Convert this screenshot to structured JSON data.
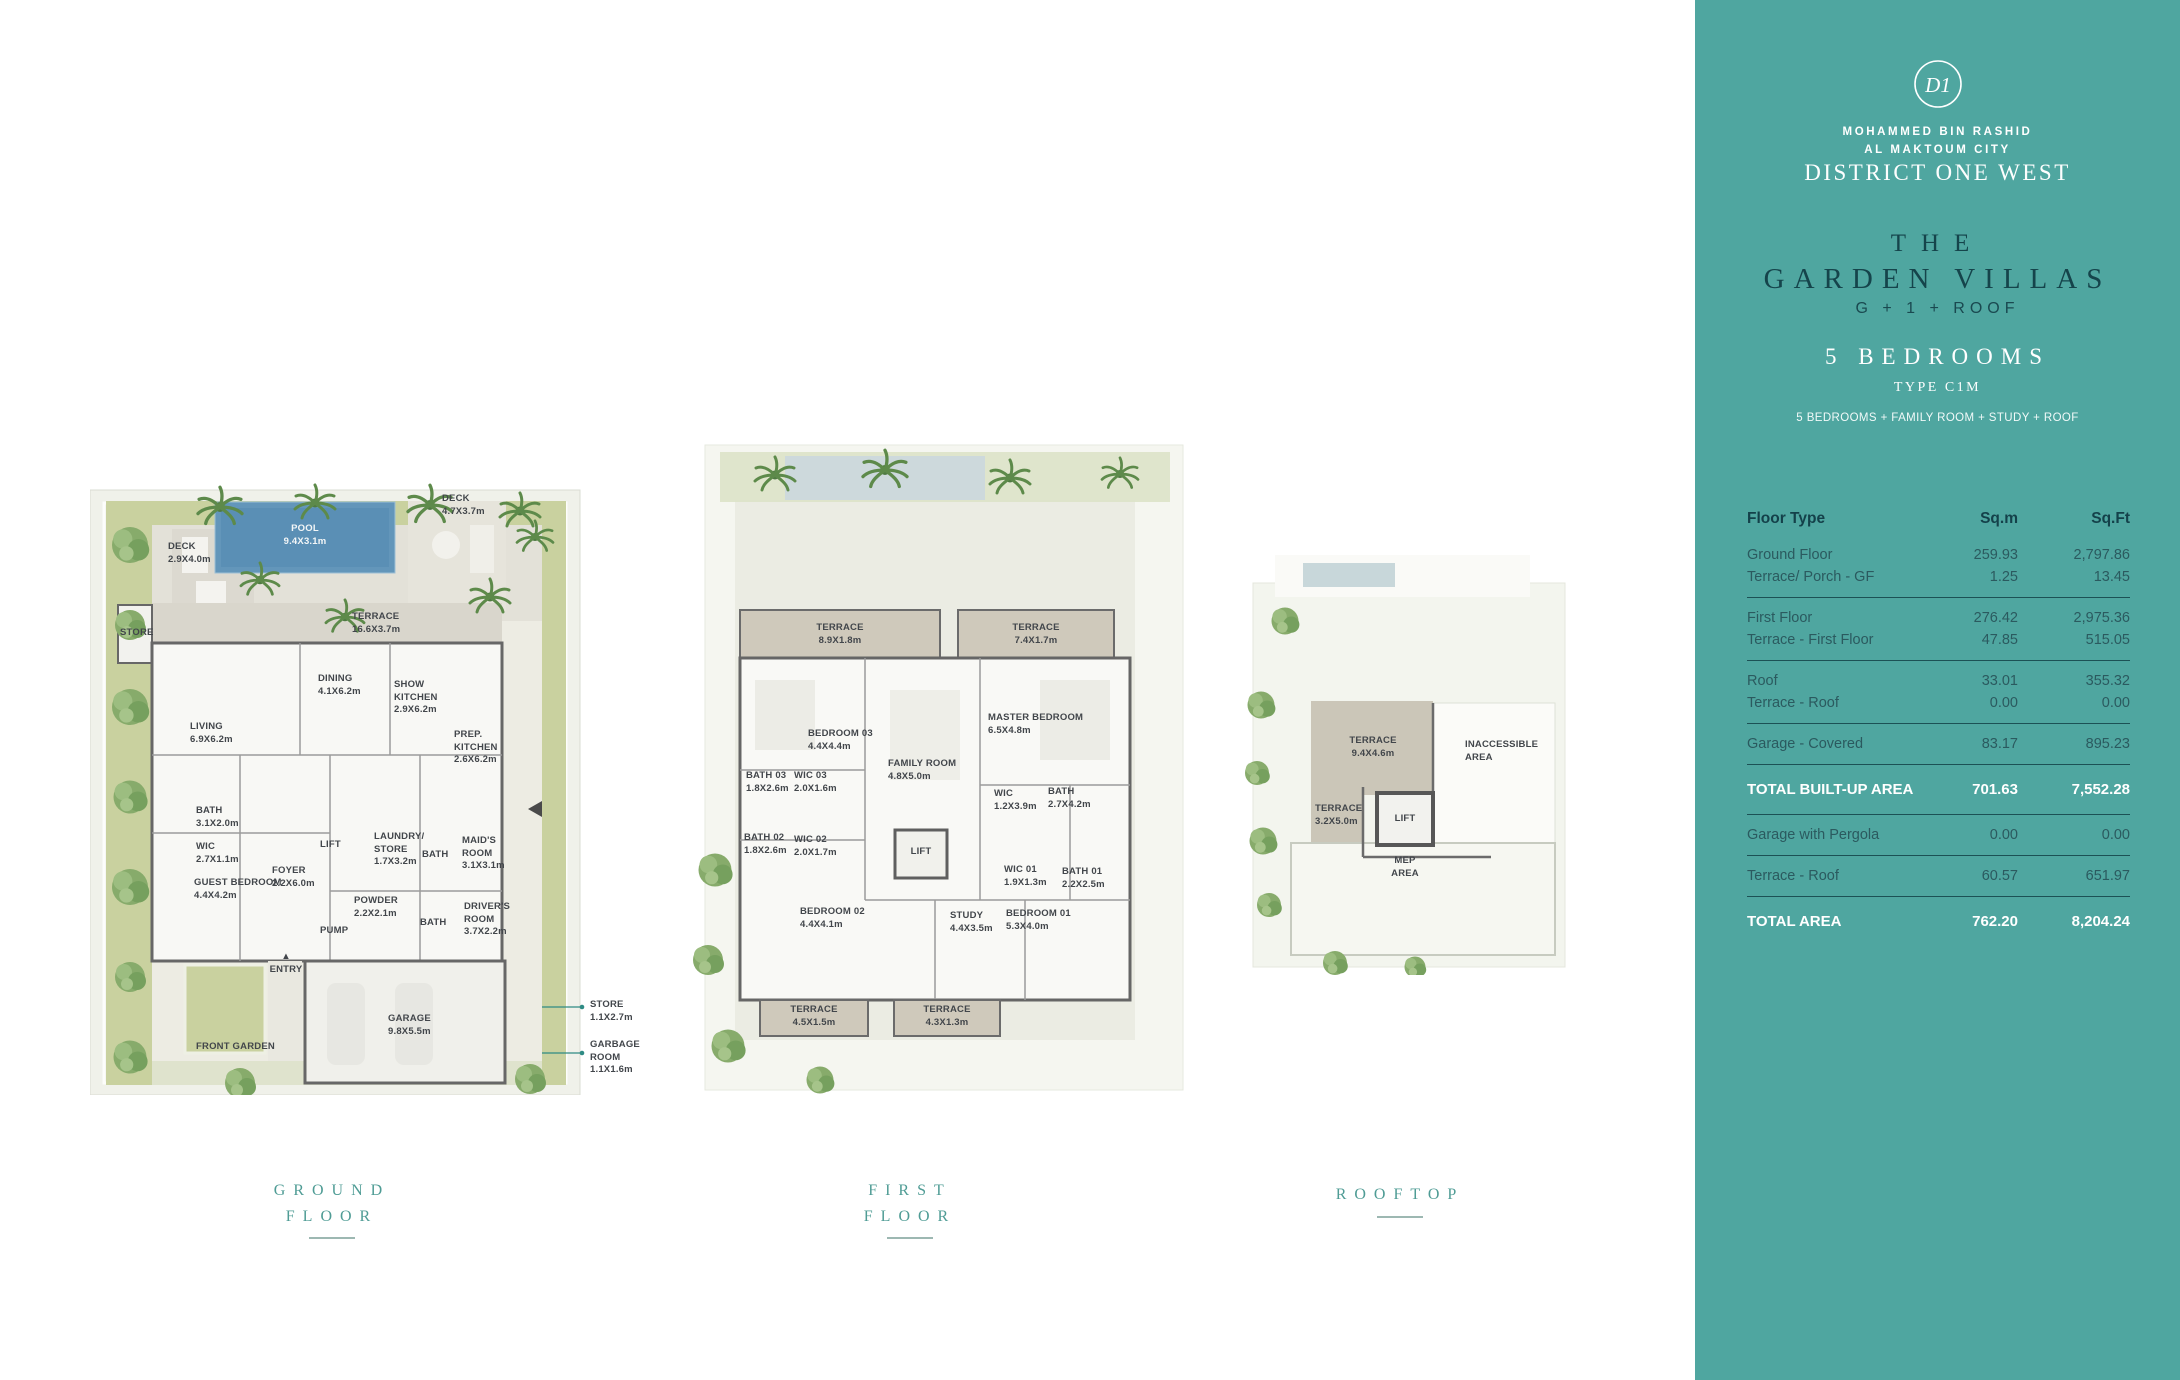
{
  "brand": {
    "logo_monogram": "D1",
    "org_line1": "MOHAMMED BIN RASHID",
    "org_line2": "AL MAKTOUM CITY",
    "development": "DISTRICT ONE WEST"
  },
  "villa": {
    "title_line1": "THE",
    "title_line2": "GARDEN VILLAS",
    "config": "G + 1 + ROOF",
    "bedrooms": "5 BEDROOMS",
    "type": "TYPE C1M",
    "features": "5 BEDROOMS + FAMILY ROOM + STUDY + ROOF"
  },
  "area_table": {
    "headers": {
      "floor_type": "Floor Type",
      "sqm": "Sq.m",
      "sqft": "Sq.Ft"
    },
    "groups": [
      {
        "rows": [
          {
            "label": "Ground Floor",
            "sqm": "259.93",
            "sqft": "2,797.86"
          },
          {
            "label": "Terrace/ Porch - GF",
            "sqm": "1.25",
            "sqft": "13.45"
          }
        ]
      },
      {
        "rows": [
          {
            "label": "First Floor",
            "sqm": "276.42",
            "sqft": "2,975.36"
          },
          {
            "label": "Terrace - First Floor",
            "sqm": "47.85",
            "sqft": "515.05"
          }
        ]
      },
      {
        "rows": [
          {
            "label": "Roof",
            "sqm": "33.01",
            "sqft": "355.32"
          },
          {
            "label": "Terrace - Roof",
            "sqm": "0.00",
            "sqft": "0.00"
          }
        ]
      },
      {
        "rows": [
          {
            "label": "Garage - Covered",
            "sqm": "83.17",
            "sqft": "895.23"
          }
        ]
      },
      {
        "rows": [
          {
            "label": "TOTAL BUILT-UP AREA",
            "sqm": "701.63",
            "sqft": "7,552.28",
            "total": true
          }
        ]
      },
      {
        "rows": [
          {
            "label": "Garage with Pergola",
            "sqm": "0.00",
            "sqft": "0.00"
          }
        ]
      },
      {
        "rows": [
          {
            "label": "Terrace - Roof",
            "sqm": "60.57",
            "sqft": "651.97"
          }
        ]
      },
      {
        "rows": [
          {
            "label": "TOTAL AREA",
            "sqm": "762.20",
            "sqft": "8,204.24",
            "total": true
          }
        ]
      }
    ]
  },
  "plans": [
    {
      "id": "ground",
      "title_lines": [
        "GROUND",
        "FLOOR"
      ],
      "labels": [
        {
          "lines": [
            "DECK",
            "2.9X4.0m"
          ],
          "x": 78,
          "y": 96
        },
        {
          "lines": [
            "POOL",
            "9.4X3.1m"
          ],
          "x": 215,
          "y": 78,
          "align": "center",
          "color": "light"
        },
        {
          "lines": [
            "DECK",
            "4.7X3.7m"
          ],
          "x": 352,
          "y": 48
        },
        {
          "lines": [
            "STORE"
          ],
          "x": 30,
          "y": 182
        },
        {
          "lines": [
            "TERRACE",
            "16.6X3.7m"
          ],
          "x": 262,
          "y": 166
        },
        {
          "lines": [
            "DINING",
            "4.1X6.2m"
          ],
          "x": 228,
          "y": 228
        },
        {
          "lines": [
            "SHOW",
            "KITCHEN",
            "2.9X6.2m"
          ],
          "x": 304,
          "y": 234
        },
        {
          "lines": [
            "LIVING",
            "6.9X6.2m"
          ],
          "x": 100,
          "y": 276
        },
        {
          "lines": [
            "PREP.",
            "KITCHEN",
            "2.6X6.2m"
          ],
          "x": 364,
          "y": 284
        },
        {
          "lines": [
            "BATH",
            "3.1X2.0m"
          ],
          "x": 106,
          "y": 360
        },
        {
          "lines": [
            "WIC",
            "2.7X1.1m"
          ],
          "x": 106,
          "y": 396
        },
        {
          "lines": [
            "LIFT"
          ],
          "x": 230,
          "y": 394
        },
        {
          "lines": [
            "LAUNDRY/",
            "STORE",
            "1.7X3.2m"
          ],
          "x": 284,
          "y": 386
        },
        {
          "lines": [
            "BATH"
          ],
          "x": 332,
          "y": 404
        },
        {
          "lines": [
            "MAID'S",
            "ROOM",
            "3.1X3.1m"
          ],
          "x": 372,
          "y": 390
        },
        {
          "lines": [
            "FOYER",
            "2.2X6.0m"
          ],
          "x": 182,
          "y": 420
        },
        {
          "lines": [
            "GUEST BEDROOM",
            "4.4X4.2m"
          ],
          "x": 104,
          "y": 432
        },
        {
          "lines": [
            "POWDER",
            "2.2X2.1m"
          ],
          "x": 264,
          "y": 450
        },
        {
          "lines": [
            "PUMP"
          ],
          "x": 230,
          "y": 480
        },
        {
          "lines": [
            "BATH"
          ],
          "x": 330,
          "y": 472
        },
        {
          "lines": [
            "DRIVER'S",
            "ROOM",
            "3.7X2.2m"
          ],
          "x": 374,
          "y": 456
        },
        {
          "lines": [
            "▲",
            "ENTRY"
          ],
          "x": 196,
          "y": 506,
          "align": "center"
        },
        {
          "lines": [
            "GARAGE",
            "9.8X5.5m"
          ],
          "x": 298,
          "y": 568
        },
        {
          "lines": [
            "FRONT GARDEN"
          ],
          "x": 106,
          "y": 596
        },
        {
          "lines": [
            "STORE",
            "1.1X2.7m"
          ],
          "x": 500,
          "y": 554
        },
        {
          "lines": [
            "GARBAGE",
            "ROOM",
            "1.1X1.6m"
          ],
          "x": 500,
          "y": 594
        }
      ]
    },
    {
      "id": "first",
      "title_lines": [
        "FIRST",
        "FLOOR"
      ],
      "labels": [
        {
          "lines": [
            "TERRACE",
            "8.9X1.8m"
          ],
          "x": 160,
          "y": 182,
          "align": "center"
        },
        {
          "lines": [
            "TERRACE",
            "7.4X1.7m"
          ],
          "x": 356,
          "y": 182,
          "align": "center"
        },
        {
          "lines": [
            "BEDROOM 03",
            "4.4X4.4m"
          ],
          "x": 128,
          "y": 288
        },
        {
          "lines": [
            "MASTER BEDROOM",
            "6.5X4.8m"
          ],
          "x": 308,
          "y": 272
        },
        {
          "lines": [
            "FAMILY ROOM",
            "4.8X5.0m"
          ],
          "x": 208,
          "y": 318
        },
        {
          "lines": [
            "BATH 03",
            "1.8X2.6m"
          ],
          "x": 66,
          "y": 330
        },
        {
          "lines": [
            "WIC 03",
            "2.0X1.6m"
          ],
          "x": 114,
          "y": 330
        },
        {
          "lines": [
            "BATH 02",
            "1.8X2.6m"
          ],
          "x": 64,
          "y": 392
        },
        {
          "lines": [
            "WIC 02",
            "2.0X1.7m"
          ],
          "x": 114,
          "y": 394
        },
        {
          "lines": [
            "LIFT"
          ],
          "x": 241,
          "y": 406,
          "align": "center"
        },
        {
          "lines": [
            "WIC",
            "1.2X3.9m"
          ],
          "x": 314,
          "y": 348
        },
        {
          "lines": [
            "BATH",
            "2.7X4.2m"
          ],
          "x": 368,
          "y": 346
        },
        {
          "lines": [
            "WIC 01",
            "1.9X1.3m"
          ],
          "x": 324,
          "y": 424
        },
        {
          "lines": [
            "BATH 01",
            "2.2X2.5m"
          ],
          "x": 382,
          "y": 426
        },
        {
          "lines": [
            "BEDROOM 02",
            "4.4X4.1m"
          ],
          "x": 120,
          "y": 466
        },
        {
          "lines": [
            "STUDY",
            "4.4X3.5m"
          ],
          "x": 270,
          "y": 470
        },
        {
          "lines": [
            "BEDROOM 01",
            "5.3X4.0m"
          ],
          "x": 326,
          "y": 468
        },
        {
          "lines": [
            "TERRACE",
            "4.5X1.5m"
          ],
          "x": 134,
          "y": 564,
          "align": "center"
        },
        {
          "lines": [
            "TERRACE",
            "4.3X1.3m"
          ],
          "x": 267,
          "y": 564,
          "align": "center"
        }
      ]
    },
    {
      "id": "roof",
      "title_lines": [
        "ROOFTOP"
      ],
      "labels": [
        {
          "lines": [
            "TERRACE",
            "9.4X4.6m"
          ],
          "x": 128,
          "y": 180,
          "align": "center"
        },
        {
          "lines": [
            "INACCESSIBLE",
            "AREA"
          ],
          "x": 220,
          "y": 184
        },
        {
          "lines": [
            "TERRACE",
            "3.2X5.0m"
          ],
          "x": 70,
          "y": 248
        },
        {
          "lines": [
            "LIFT"
          ],
          "x": 160,
          "y": 258,
          "align": "center"
        },
        {
          "lines": [
            "MEP",
            "AREA"
          ],
          "x": 160,
          "y": 300,
          "align": "center"
        }
      ]
    }
  ],
  "colors": {
    "sidebar_teal": "#4fa6a0",
    "dark_heading": "#15444b",
    "pool_blue": "#6396ba",
    "garden_green": "#c9d19f",
    "tree_green": "#87ab6b",
    "terrace_gray": "#d9d6cc",
    "plan_title_teal": "#4f9c95"
  }
}
